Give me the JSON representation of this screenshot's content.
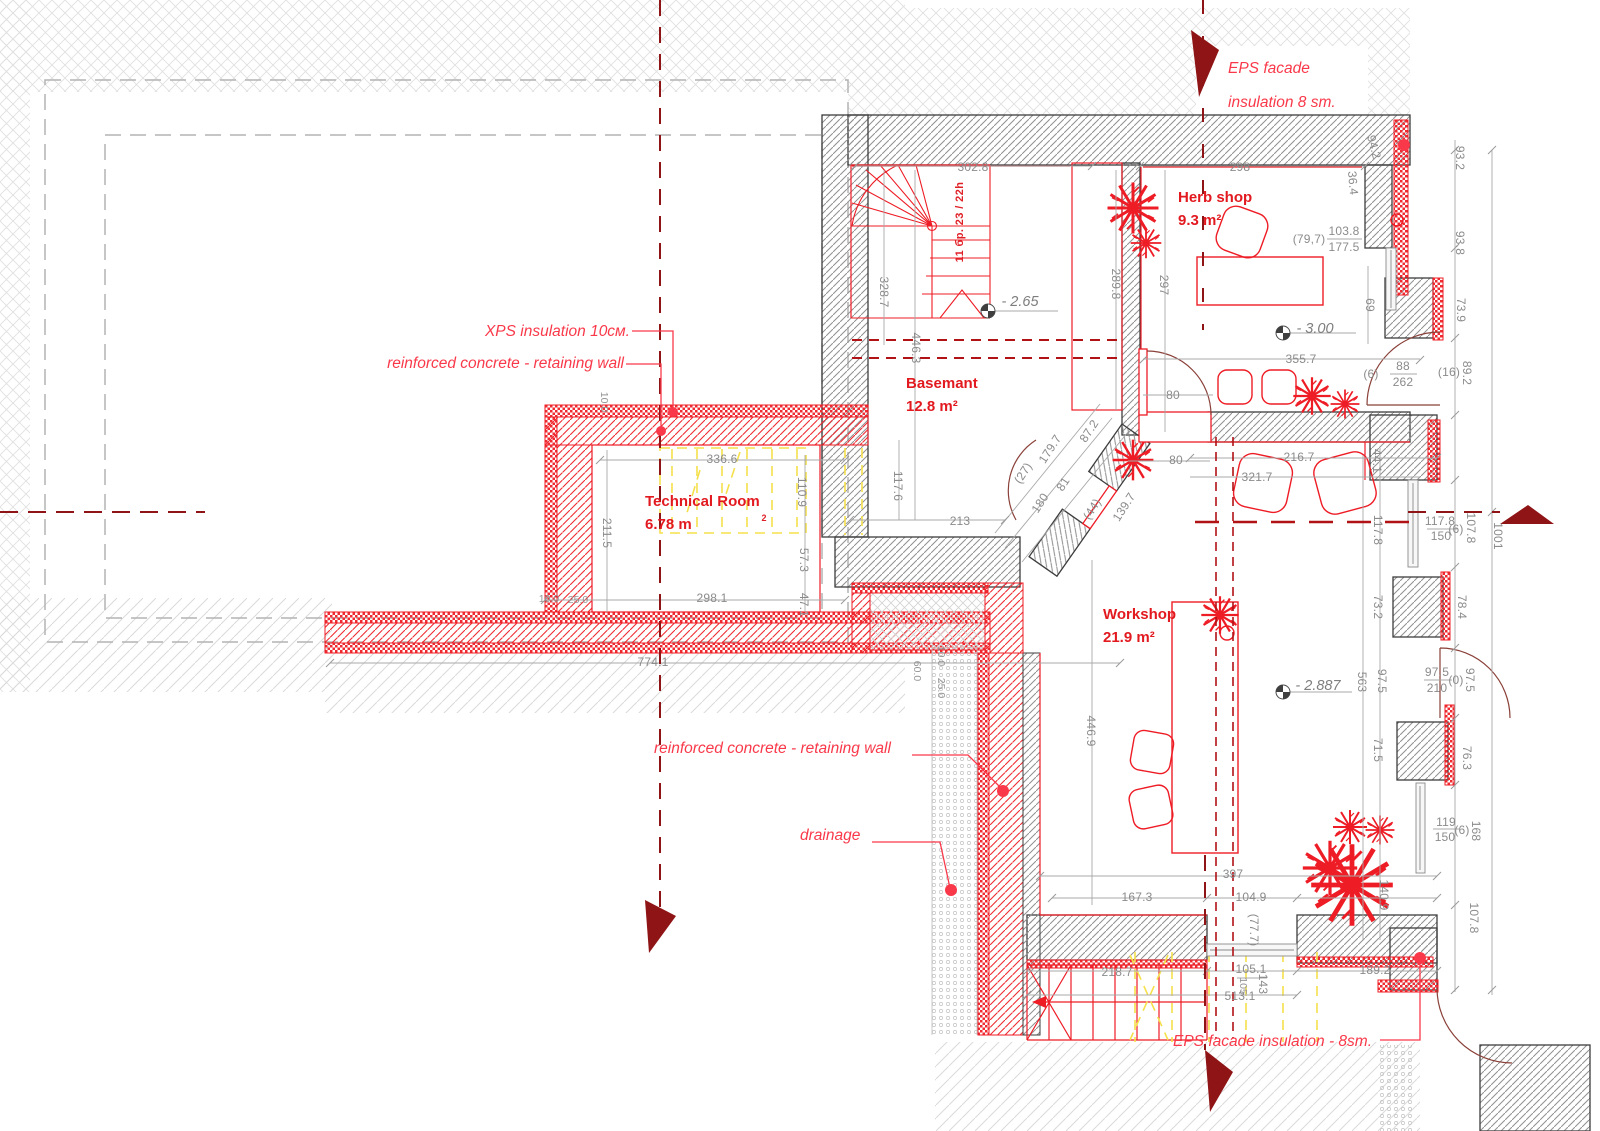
{
  "drawing": {
    "type": "basement floor plan",
    "accent_red": "#ee1c25",
    "dark_red": "#8f1416",
    "annotation_red": "#f9394a",
    "dim_gray": "#8b8b8b",
    "yellow": "#f5e04b"
  },
  "rooms": [
    {
      "name": "Herb shop",
      "area": "9.3 m²"
    },
    {
      "name": "Basemant",
      "area": "12.8 m²"
    },
    {
      "name": "Technical Room",
      "area": "6.78 m"
    },
    {
      "name": "Workshop",
      "area": "21.9 m²"
    }
  ],
  "annotations": [
    {
      "text": "XPS insulation 10см."
    },
    {
      "text": "reinforced concrete - retaining wall"
    },
    {
      "text": "reinforced concrete - retaining wall"
    },
    {
      "text": "drainage"
    },
    {
      "text": "EPS  facade"
    },
    {
      "text": "insulation 8 sm."
    },
    {
      "text": "EPS  facade insulation - 8sm."
    }
  ],
  "levels": [
    "- 2.65",
    "- 3.00",
    "- 2.887"
  ],
  "stair_note": "11 бр. 23 / 22h",
  "texts": [
    {
      "t": "302.8",
      "x": 973,
      "y": 167
    },
    {
      "t": "328.7",
      "x": 884,
      "y": 292,
      "r": 90
    },
    {
      "t": "446.3",
      "x": 916,
      "y": 348,
      "r": 90
    },
    {
      "t": "117.6",
      "x": 898,
      "y": 486,
      "r": 90
    },
    {
      "t": "213",
      "x": 960,
      "y": 521
    },
    {
      "t": "289.8",
      "x": 1116,
      "y": 284,
      "r": 90
    },
    {
      "t": "297",
      "x": 1164,
      "y": 285,
      "r": 90
    },
    {
      "t": "298",
      "x": 1240,
      "y": 167
    },
    {
      "t": "94.2",
      "x": 1374,
      "y": 147,
      "r": 75
    },
    {
      "t": "36.4",
      "x": 1353,
      "y": 183,
      "r": 85
    },
    {
      "t": "(79,7)",
      "x": 1309,
      "y": 239
    },
    {
      "t": "103.8",
      "x": 1344,
      "y": 231
    },
    {
      "t": "177.5",
      "x": 1344,
      "y": 247
    },
    {
      "t": "69",
      "x": 1370,
      "y": 305,
      "r": 90
    },
    {
      "t": "93.2",
      "x": 1460,
      "y": 158,
      "r": 90
    },
    {
      "t": "93.8",
      "x": 1460,
      "y": 243,
      "r": 90
    },
    {
      "t": "73.9",
      "x": 1461,
      "y": 310,
      "r": 90
    },
    {
      "t": "89.2",
      "x": 1467,
      "y": 373,
      "r": 90
    },
    {
      "t": "(6)",
      "x": 1371,
      "y": 374
    },
    {
      "t": "88",
      "x": 1403,
      "y": 366
    },
    {
      "t": "262",
      "x": 1403,
      "y": 382
    },
    {
      "t": "(16)",
      "x": 1449,
      "y": 372
    },
    {
      "t": "355.7",
      "x": 1301,
      "y": 359
    },
    {
      "t": "80",
      "x": 1173,
      "y": 395
    },
    {
      "t": "80",
      "x": 1176,
      "y": 460
    },
    {
      "t": "216.7",
      "x": 1299,
      "y": 457
    },
    {
      "t": "321.7",
      "x": 1257,
      "y": 477
    },
    {
      "t": "44.1",
      "x": 1377,
      "y": 461,
      "r": 90
    },
    {
      "t": "87.2",
      "x": 1089,
      "y": 431,
      "r": -57
    },
    {
      "t": "179.7",
      "x": 1050,
      "y": 449,
      "r": -57
    },
    {
      "t": "(27)",
      "x": 1023,
      "y": 473,
      "r": -57
    },
    {
      "t": "81",
      "x": 1063,
      "y": 484,
      "r": -57
    },
    {
      "t": "180",
      "x": 1040,
      "y": 503,
      "r": -57
    },
    {
      "t": "(44)",
      "x": 1092,
      "y": 509,
      "r": -57
    },
    {
      "t": "139.7",
      "x": 1124,
      "y": 507,
      "r": -57
    },
    {
      "t": "117.8",
      "x": 1378,
      "y": 530,
      "r": 90
    },
    {
      "t": "117.8",
      "x": 1440,
      "y": 521
    },
    {
      "t": "150",
      "x": 1441,
      "y": 536
    },
    {
      "t": "(6)",
      "x": 1456,
      "y": 529
    },
    {
      "t": "107.8",
      "x": 1471,
      "y": 528,
      "r": 90
    },
    {
      "t": "1001",
      "x": 1498,
      "y": 536,
      "r": 90
    },
    {
      "t": "78.4",
      "x": 1462,
      "y": 607,
      "r": 90
    },
    {
      "t": "73.2",
      "x": 1378,
      "y": 607,
      "r": 90
    },
    {
      "t": "563",
      "x": 1362,
      "y": 682,
      "r": 90
    },
    {
      "t": "97.5",
      "x": 1382,
      "y": 681,
      "r": 90
    },
    {
      "t": "97.5",
      "x": 1437,
      "y": 672
    },
    {
      "t": "210",
      "x": 1437,
      "y": 688
    },
    {
      "t": "(0)",
      "x": 1456,
      "y": 680
    },
    {
      "t": "97.5",
      "x": 1470,
      "y": 680,
      "r": 90
    },
    {
      "t": "71.5",
      "x": 1378,
      "y": 750,
      "r": 90
    },
    {
      "t": "76.3",
      "x": 1467,
      "y": 758,
      "r": 90
    },
    {
      "t": "119",
      "x": 1446,
      "y": 822
    },
    {
      "t": "150",
      "x": 1445,
      "y": 837
    },
    {
      "t": "(6)",
      "x": 1462,
      "y": 830
    },
    {
      "t": "168",
      "x": 1476,
      "y": 831,
      "r": 90
    },
    {
      "t": "140.9",
      "x": 1384,
      "y": 895,
      "r": 90
    },
    {
      "t": "107.8",
      "x": 1474,
      "y": 918,
      "r": 90
    },
    {
      "t": "446.9",
      "x": 1091,
      "y": 731,
      "r": 90
    },
    {
      "t": "397",
      "x": 1233,
      "y": 874
    },
    {
      "t": "167.3",
      "x": 1137,
      "y": 897
    },
    {
      "t": "104.9",
      "x": 1251,
      "y": 897
    },
    {
      "t": "(77.7)",
      "x": 1254,
      "y": 930,
      "r": 90
    },
    {
      "t": "218.7",
      "x": 1117,
      "y": 972
    },
    {
      "t": "105.1",
      "x": 1251,
      "y": 969
    },
    {
      "t": "105",
      "x": 1243,
      "y": 986,
      "r": 90,
      "c": "dimS"
    },
    {
      "t": "143",
      "x": 1263,
      "y": 984,
      "r": 90
    },
    {
      "t": "513.1",
      "x": 1240,
      "y": 996
    },
    {
      "t": "189.2",
      "x": 1375,
      "y": 970
    },
    {
      "t": "336.6",
      "x": 722,
      "y": 459
    },
    {
      "t": "110.9",
      "x": 802,
      "y": 492,
      "r": 90
    },
    {
      "t": "211.5",
      "x": 607,
      "y": 533,
      "r": 90
    },
    {
      "t": "57.3",
      "x": 804,
      "y": 560,
      "r": 90
    },
    {
      "t": "47.1",
      "x": 804,
      "y": 605,
      "r": 90
    },
    {
      "t": "298.1",
      "x": 712,
      "y": 598
    },
    {
      "t": "10.0",
      "x": 549,
      "y": 599,
      "c": "dimS"
    },
    {
      "t": "25.0",
      "x": 578,
      "y": 600,
      "c": "dimS"
    },
    {
      "t": "10.0",
      "x": 604,
      "y": 402,
      "r": 90,
      "c": "dimS"
    },
    {
      "t": "774.1",
      "x": 653,
      "y": 662
    },
    {
      "t": "60.0",
      "x": 917,
      "y": 671,
      "r": 90,
      "c": "dimS"
    },
    {
      "t": "10.0",
      "x": 941,
      "y": 656,
      "r": 90,
      "c": "dimS"
    },
    {
      "t": "25.0",
      "x": 941,
      "y": 688,
      "r": 90,
      "c": "dimS"
    },
    {
      "t": "- 2.65",
      "x": 1020,
      "y": 302,
      "c": "lvl",
      "n": "level-mark"
    },
    {
      "t": "- 3.00",
      "x": 1315,
      "y": 329,
      "c": "lvl",
      "n": "level-mark"
    },
    {
      "t": "- 2.887",
      "x": 1318,
      "y": 686,
      "c": "lvl",
      "n": "level-mark"
    },
    {
      "t": "11 бр. 23 / 22h",
      "x": 960,
      "y": 222,
      "r": -90,
      "c": "red",
      "n": "stair-note"
    },
    {
      "t": "2",
      "x": 764,
      "y": 518,
      "c": "sup",
      "n": "area-superscript"
    }
  ]
}
